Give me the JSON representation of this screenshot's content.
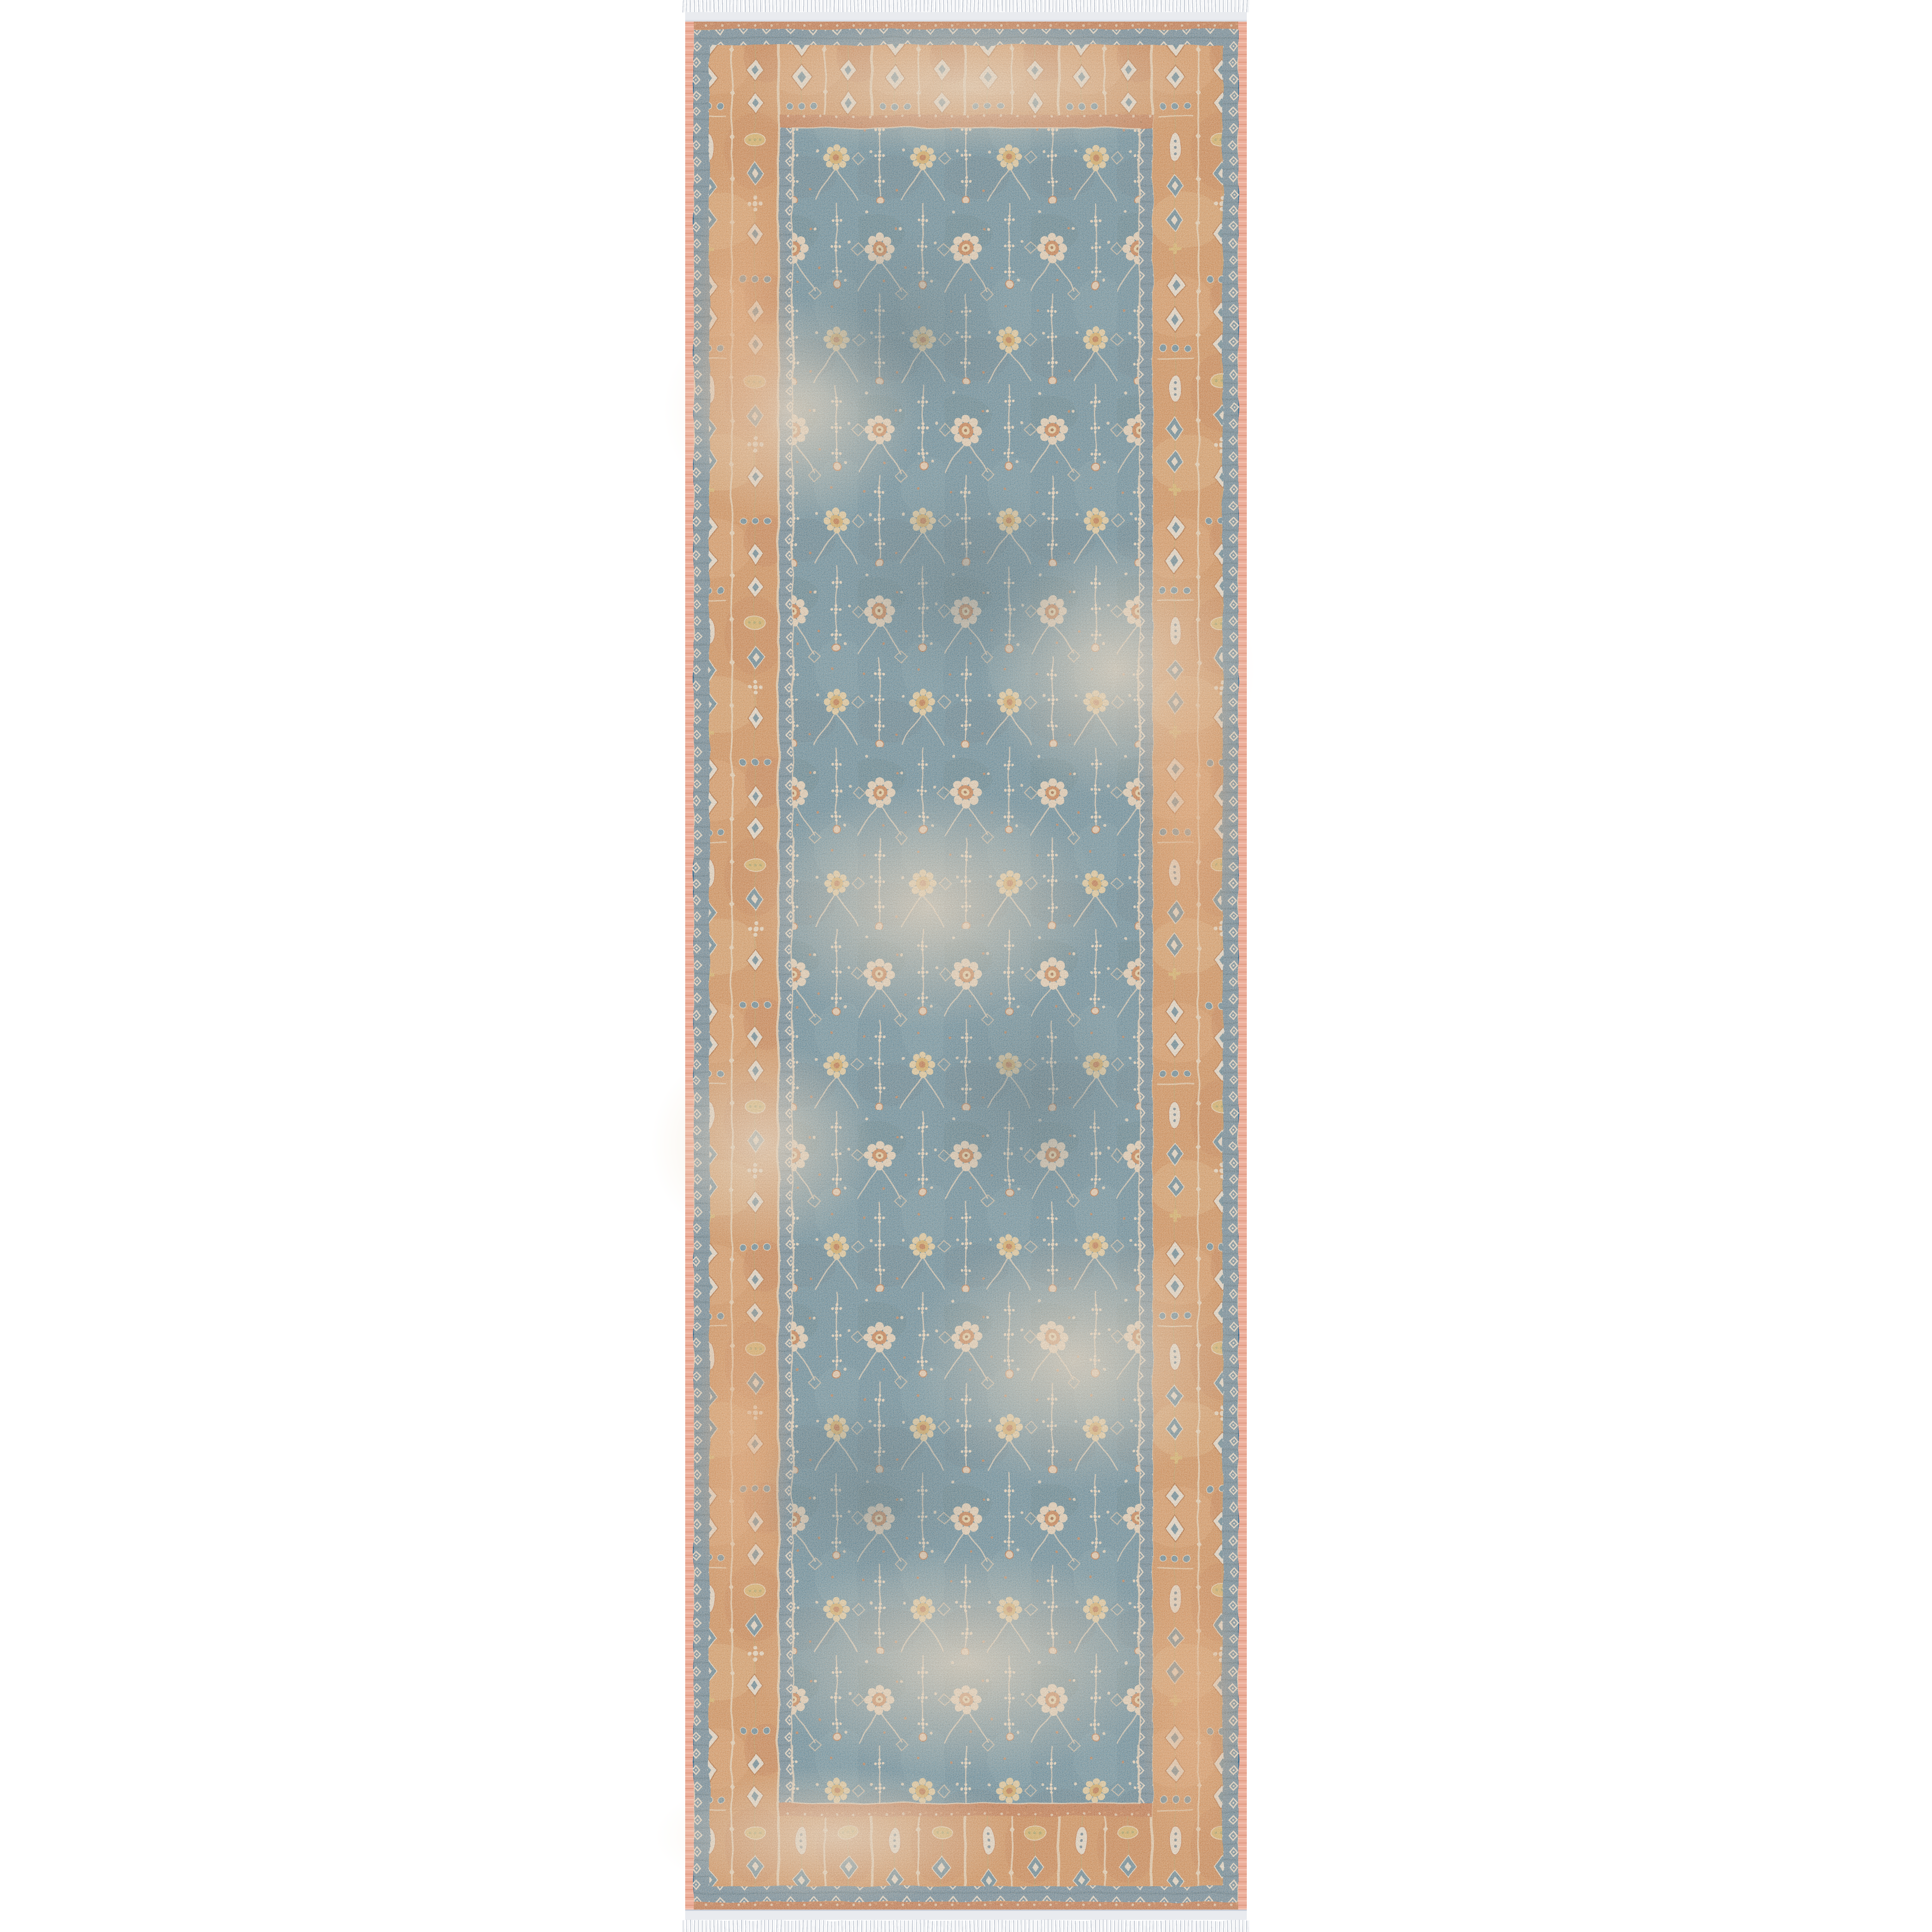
{
  "scene": {
    "type": "product photo",
    "subject": "vintage-style Persian floral runner rug, flat top-down view",
    "background_color": "#ffffff",
    "rug_orientation": "vertical runner, centered horizontally, full image height",
    "fringe": {
      "position": "top and bottom edges",
      "thread_color": "#c9ced7",
      "base_color": "#ffffff"
    }
  },
  "rug": {
    "palette": {
      "background": "#ffffff",
      "fringe_thread": "#c9ced7",
      "kilim_band": "#e9ebef",
      "selvedge_pink": "#ecaf9b",
      "outer_strip_rust": "#b45c2e",
      "guard_blue": "#49799a",
      "border_orange": "#d08040",
      "inner_guard_rust": "#bc6233",
      "field_blue": "#3e7c9e",
      "motif_cream": "#e7d7c1",
      "motif_gold": "#d2a54f",
      "motif_rust": "#c06a36",
      "accent_olive": "#9a9950",
      "diamond_white": "#eae5da",
      "diamond_blue": "#3f7795"
    },
    "field": {
      "background": "#3e7c9e",
      "motifs": [
        "round floral rosettes with orange centers",
        "gold rosettes",
        "vertical cream vine stems with star blossoms",
        "diamond lattice outlines",
        "scattered petal dots"
      ],
      "style": "distressed / faded allover floral"
    },
    "border": {
      "background": "#d08040",
      "motifs": [
        "stacked white diamonds with blue centers",
        "stacked blue diamonds with white centers",
        "rows of blue dots",
        "white boteh leaves",
        "gold ovals and crosses",
        "thin cream guard stripes with bead chains"
      ]
    },
    "guards": {
      "outer": "blue band with white diamond chain",
      "inner_top_bottom": "rust band with cream dots",
      "inner_sides": "blue band with white diamond chain"
    },
    "selvedge": {
      "color": "#ecaf9b",
      "position": "left and right edges"
    }
  }
}
